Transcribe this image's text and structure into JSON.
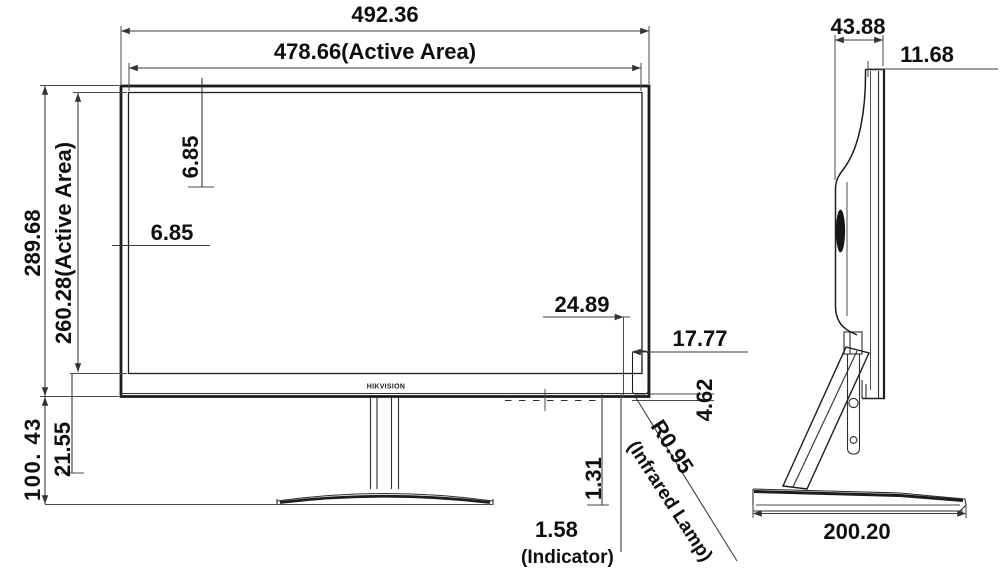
{
  "drawing": {
    "type": "monitor-dimension-drawing",
    "units_note": "millimeters (implied)",
    "line_color": "#1d1d1d",
    "text_color": "#0f0f0f",
    "background": "#ffffff"
  },
  "front_view": {
    "logo": "HIKVISION",
    "dims": {
      "overall_width": "492.36",
      "active_width": "478.66(Active Area)",
      "overall_height": "289.68",
      "active_height": "260.28(Active Area)",
      "top_bezel_gap": "6.85",
      "side_bezel_gap": "6.85",
      "chin_height": "21.55",
      "stand_height": "100. 43",
      "lamp_offset": "24.89",
      "lamp_width": "17.77",
      "lamp_height": "4.62",
      "lamp_radius": "R0.95",
      "lamp_note": "(Infrared Lamp)",
      "indicator_offset": "1.31",
      "indicator_size": "1.58",
      "indicator_note": "(Indicator)"
    }
  },
  "side_view": {
    "dims": {
      "depth": "43.88",
      "top_thickness": "11.68",
      "base_depth": "200.20"
    }
  }
}
